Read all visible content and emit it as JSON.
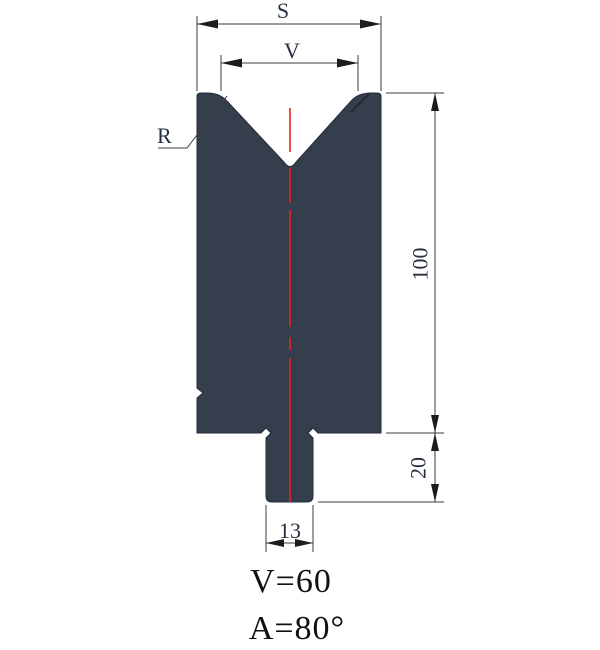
{
  "labels": {
    "s": "S",
    "v": "V",
    "r": "R",
    "body_height": "100",
    "shank_height": "20",
    "shank_width": "13"
  },
  "notes": {
    "v_equation": "V=60",
    "a_equation": "A=80°"
  },
  "colors": {
    "die_fill": "#343e4d",
    "die_stroke": "#232c39",
    "centerline": "#e8201e",
    "dimension_line": "#3d3d3d",
    "arrow": "#1c1c1c",
    "label_text": "#26303f",
    "note_text": "#111111",
    "background": "#ffffff"
  }
}
